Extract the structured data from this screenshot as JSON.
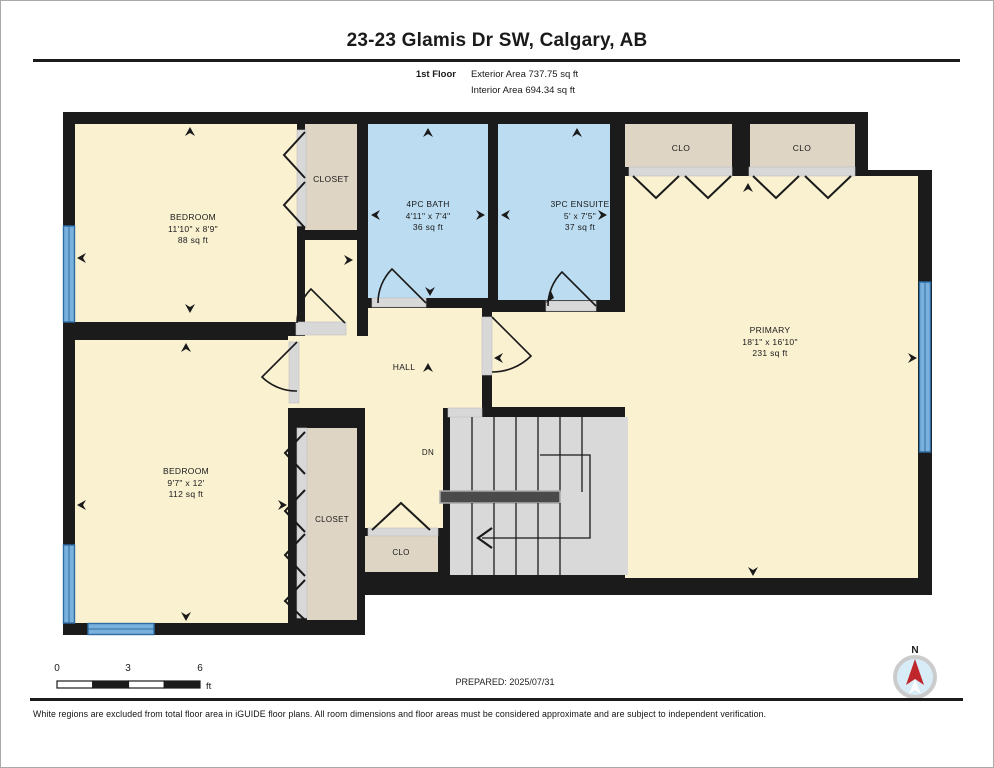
{
  "header": {
    "title": "23-23 Glamis Dr SW, Calgary, AB",
    "floor_label": "1st Floor",
    "exterior_area": "Exterior Area 737.75 sq ft",
    "interior_area": "Interior Area 694.34 sq ft"
  },
  "rooms": {
    "bedroom1": {
      "name": "BEDROOM",
      "dims": "11'10\" x 8'9\"",
      "area": "88 sq ft"
    },
    "closet1": {
      "name": "CLOSET"
    },
    "bath": {
      "name": "4PC BATH",
      "dims": "4'11\" x 7'4\"",
      "area": "36 sq ft"
    },
    "ensuite": {
      "name": "3PC ENSUITE",
      "dims": "5' x 7'5\"",
      "area": "37 sq ft"
    },
    "clo1": {
      "name": "CLO"
    },
    "clo2": {
      "name": "CLO"
    },
    "primary": {
      "name": "PRIMARY",
      "dims": "18'1\" x 16'10\"",
      "area": "231 sq ft"
    },
    "hall": {
      "name": "HALL"
    },
    "stairs": {
      "name": "DN"
    },
    "bedroom2": {
      "name": "BEDROOM",
      "dims": "9'7\" x 12'",
      "area": "112 sq ft"
    },
    "closet2": {
      "name": "CLOSET"
    },
    "clo3": {
      "name": "CLO"
    }
  },
  "footer": {
    "scale": {
      "t0": "0",
      "t3": "3",
      "t6": "6",
      "unit": "ft"
    },
    "prepared": "PREPARED: 2025/07/31",
    "compass_label": "N",
    "disclaimer": "White regions are excluded from total floor area in iGUIDE floor plans. All room dimensions and floor areas must be considered approximate and are subject to independent verification."
  },
  "colors": {
    "wall": "#1b1b1b",
    "room_fill": "#FAF1D1",
    "bath_fill": "#BCDDF1",
    "closet_fill": "#DFD5C4",
    "stairs_fill": "#D9D9D9",
    "window_fill": "#79B1DC",
    "window_line": "#2E6DA4",
    "sill_fill": "#D8D8D8",
    "compass_needle": "#C0272D",
    "compass_face": "#D8ECF7"
  }
}
